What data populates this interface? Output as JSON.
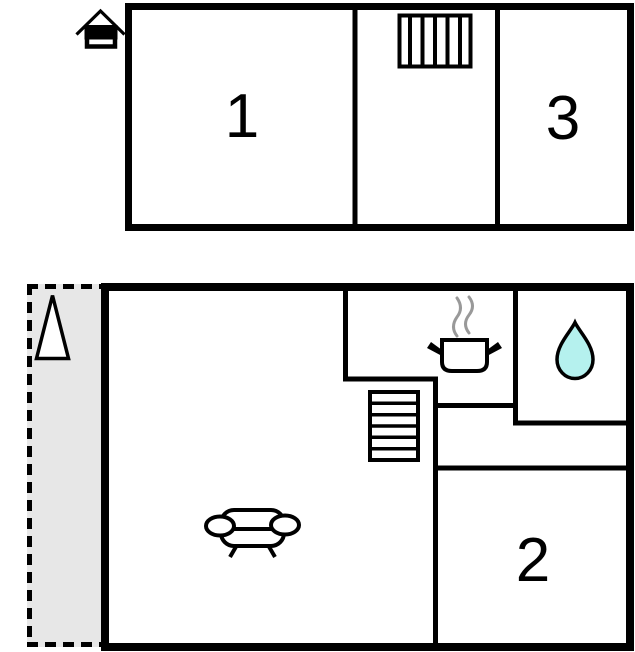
{
  "colors": {
    "background": "#ffffff",
    "walls": "#000000",
    "terrace_fill": "#e7e7e7",
    "water_drop_fill": "#b5f1ee",
    "steam": "#999999"
  },
  "upper_floor": {
    "rooms": [
      {
        "label": "1"
      },
      {
        "label": "3"
      }
    ],
    "icons": [
      "house-icon",
      "ladder-icon"
    ]
  },
  "ground_floor": {
    "rooms": [
      {
        "label": "2"
      }
    ],
    "icons": [
      "triangle-icon",
      "staircase-icon",
      "cooking-pot-icon",
      "steam-icon",
      "water-drop-icon",
      "sofa-icon"
    ]
  }
}
